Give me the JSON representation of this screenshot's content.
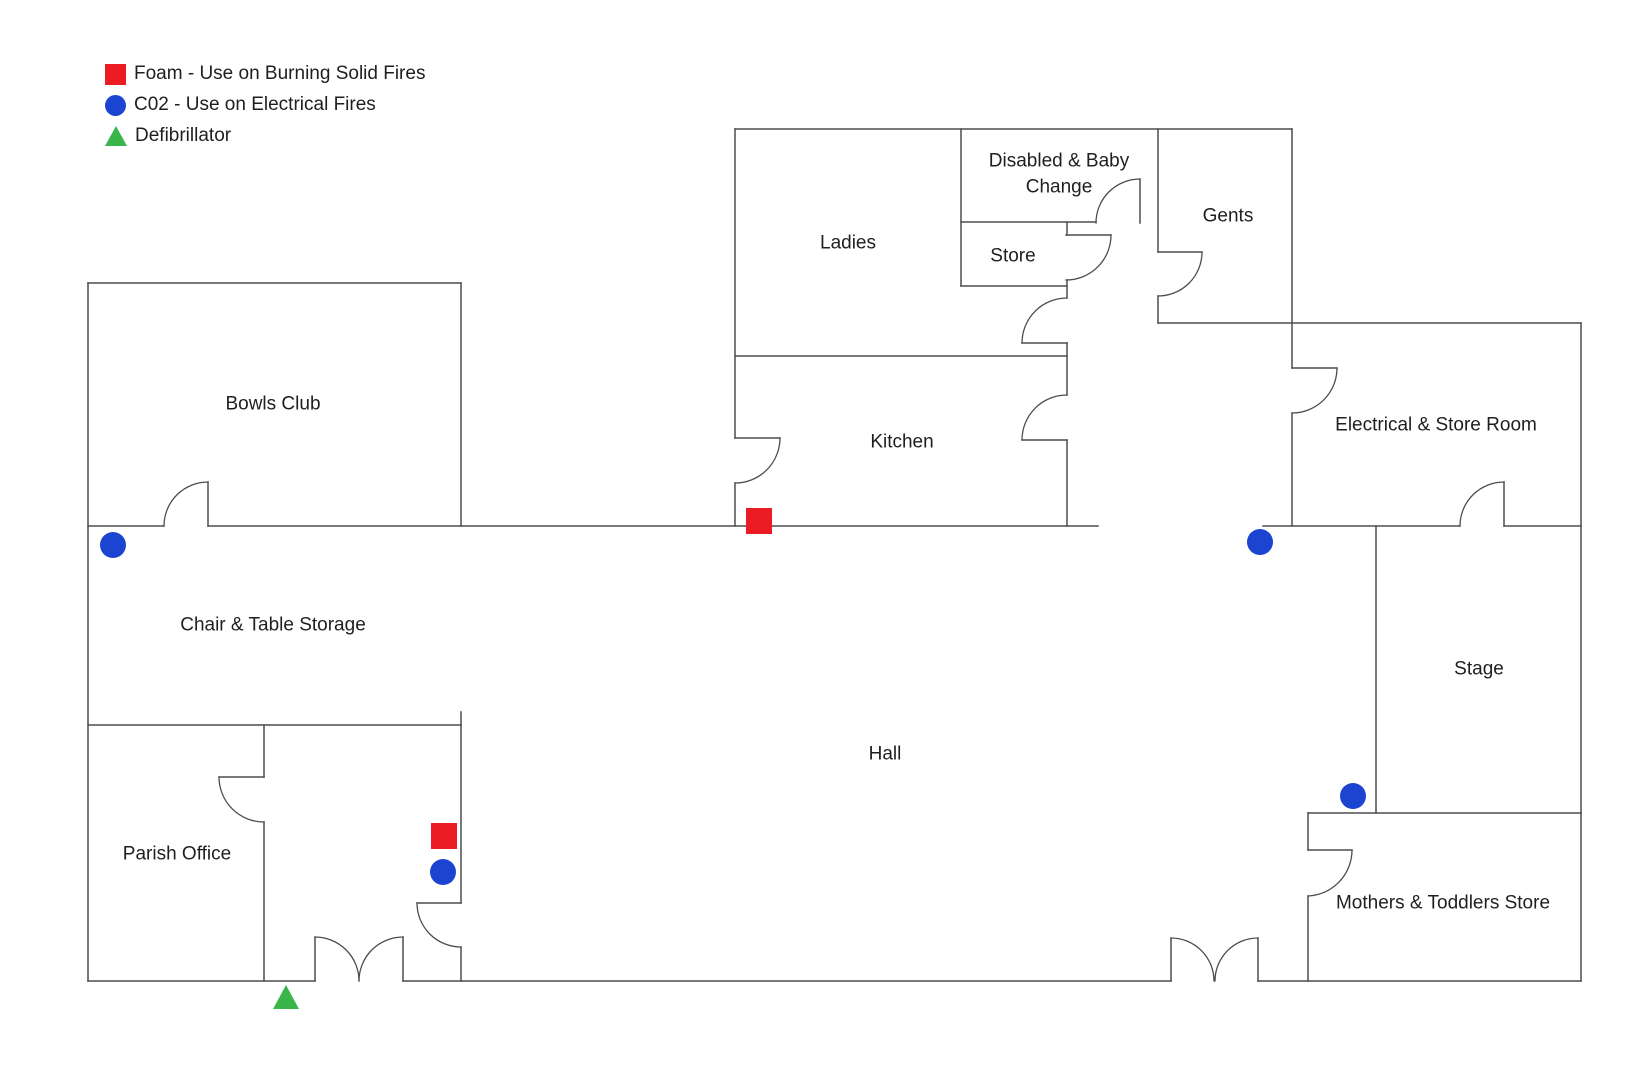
{
  "colors": {
    "foam_red": "#ec1c24",
    "co2_blue": "#1b44d0",
    "defib_green": "#3ab54a",
    "wall": "#4d4d4d",
    "text": "#1f1f1f",
    "background": "#ffffff"
  },
  "legend": {
    "items": [
      {
        "type": "foam",
        "label": "Foam - Use on Burning Solid Fires"
      },
      {
        "type": "co2",
        "label": "C02 - Use on Electrical Fires"
      },
      {
        "type": "defib",
        "label": "Defibrillator"
      }
    ]
  },
  "floorplan": {
    "canvas": {
      "width": 1644,
      "height": 1080
    },
    "rooms": [
      {
        "id": "bowls-club",
        "lines": [
          "Bowls Club"
        ],
        "x": 273,
        "y": 404
      },
      {
        "id": "ladies",
        "lines": [
          "Ladies"
        ],
        "x": 848,
        "y": 243
      },
      {
        "id": "disabled-baby-change",
        "lines": [
          "Disabled & Baby",
          "Change"
        ],
        "x": 1059,
        "y": 174
      },
      {
        "id": "store",
        "lines": [
          "Store"
        ],
        "x": 1013,
        "y": 256
      },
      {
        "id": "gents",
        "lines": [
          "Gents"
        ],
        "x": 1228,
        "y": 216
      },
      {
        "id": "kitchen",
        "lines": [
          "Kitchen"
        ],
        "x": 902,
        "y": 442
      },
      {
        "id": "electrical-store-room",
        "lines": [
          "Electrical & Store Room"
        ],
        "x": 1436,
        "y": 425
      },
      {
        "id": "chair-table-storage",
        "lines": [
          "Chair & Table Storage"
        ],
        "x": 273,
        "y": 625
      },
      {
        "id": "stage",
        "lines": [
          "Stage"
        ],
        "x": 1479,
        "y": 669
      },
      {
        "id": "hall",
        "lines": [
          "Hall"
        ],
        "x": 885,
        "y": 754
      },
      {
        "id": "parish-office",
        "lines": [
          "Parish Office"
        ],
        "x": 177,
        "y": 854
      },
      {
        "id": "mothers-toddlers-store",
        "lines": [
          "Mothers & Toddlers Store"
        ],
        "x": 1443,
        "y": 903
      }
    ],
    "walls": [
      [
        735,
        129,
        1292,
        129
      ],
      [
        961,
        222,
        1096,
        222
      ],
      [
        1066,
        235,
        1111,
        235
      ],
      [
        961,
        286,
        1067,
        286
      ],
      [
        1158,
        323,
        1581,
        323
      ],
      [
        735,
        356,
        1067,
        356
      ],
      [
        1022,
        343,
        1067,
        343
      ],
      [
        1022,
        440,
        1067,
        440
      ],
      [
        735,
        438,
        780,
        438
      ],
      [
        88,
        283,
        461,
        283
      ],
      [
        88,
        526,
        164,
        526
      ],
      [
        208,
        526,
        1098,
        526
      ],
      [
        1263,
        526,
        1460,
        526
      ],
      [
        1504,
        526,
        1581,
        526
      ],
      [
        88,
        725,
        461,
        725
      ],
      [
        219,
        777,
        264,
        777
      ],
      [
        417,
        903,
        461,
        903
      ],
      [
        1308,
        813,
        1581,
        813
      ],
      [
        1308,
        850,
        1352,
        850
      ],
      [
        1292,
        368,
        1337,
        368
      ],
      [
        1158,
        252,
        1202,
        252
      ],
      [
        88,
        981,
        315,
        981
      ],
      [
        403,
        981,
        1171,
        981
      ],
      [
        1258,
        981,
        1581,
        981
      ],
      [
        88,
        283,
        88,
        981
      ],
      [
        461,
        283,
        461,
        526
      ],
      [
        461,
        712,
        461,
        903
      ],
      [
        461,
        947,
        461,
        981
      ],
      [
        264,
        725,
        264,
        777
      ],
      [
        264,
        822,
        264,
        981
      ],
      [
        735,
        129,
        735,
        438
      ],
      [
        735,
        483,
        735,
        526
      ],
      [
        961,
        129,
        961,
        286
      ],
      [
        1067,
        222,
        1067,
        235
      ],
      [
        1067,
        280,
        1067,
        298
      ],
      [
        1067,
        343,
        1067,
        395
      ],
      [
        1067,
        440,
        1067,
        526
      ],
      [
        1140,
        179,
        1140,
        223
      ],
      [
        1158,
        129,
        1158,
        252
      ],
      [
        1158,
        296,
        1158,
        323
      ],
      [
        1292,
        129,
        1292,
        368
      ],
      [
        1292,
        413,
        1292,
        526
      ],
      [
        1581,
        323,
        1581,
        981
      ],
      [
        1376,
        526,
        1376,
        813
      ],
      [
        1308,
        813,
        1308,
        850
      ],
      [
        1308,
        896,
        1308,
        981
      ],
      [
        208,
        482,
        208,
        526
      ],
      [
        1504,
        482,
        1504,
        526
      ],
      [
        315,
        937,
        315,
        981
      ],
      [
        403,
        937,
        403,
        981
      ],
      [
        1171,
        938,
        1171,
        981
      ],
      [
        1258,
        938,
        1258,
        981
      ]
    ],
    "door_arcs": [
      "M208,482 A44,44 0 0 0 164,526",
      "M219,777 A45,45 0 0 0 264,822",
      "M417,903 A44,44 0 0 0 461,947",
      "M315,937 A44,44 0 0 1 359,981",
      "M403,937 A44,44 0 0 0 359,981",
      "M1171,938 A43,43 0 0 1 1214,981",
      "M1258,938 A43,43 0 0 0 1215,981",
      "M1352,850 A46,46 0 0 1 1308,896",
      "M1504,482 A44,44 0 0 0 1460,526",
      "M1337,368 A45,45 0 0 1 1292,413",
      "M1202,252 A44,44 0 0 1 1158,296",
      "M1140,179 A44,44 0 0 0 1096,223",
      "M1111,235 A45,45 0 0 1 1066,280",
      "M1022,343 A45,45 0 0 1 1067,298",
      "M1022,440 A45,45 0 0 1 1067,395",
      "M780,438 A45,45 0 0 1 735,483"
    ],
    "markers": [
      {
        "type": "foam",
        "x": 759,
        "y": 521
      },
      {
        "type": "foam",
        "x": 444,
        "y": 836
      },
      {
        "type": "co2",
        "x": 113,
        "y": 545
      },
      {
        "type": "co2",
        "x": 1260,
        "y": 542
      },
      {
        "type": "co2",
        "x": 1353,
        "y": 796
      },
      {
        "type": "co2",
        "x": 443,
        "y": 872
      },
      {
        "type": "defib",
        "x": 286,
        "y": 997
      }
    ]
  }
}
